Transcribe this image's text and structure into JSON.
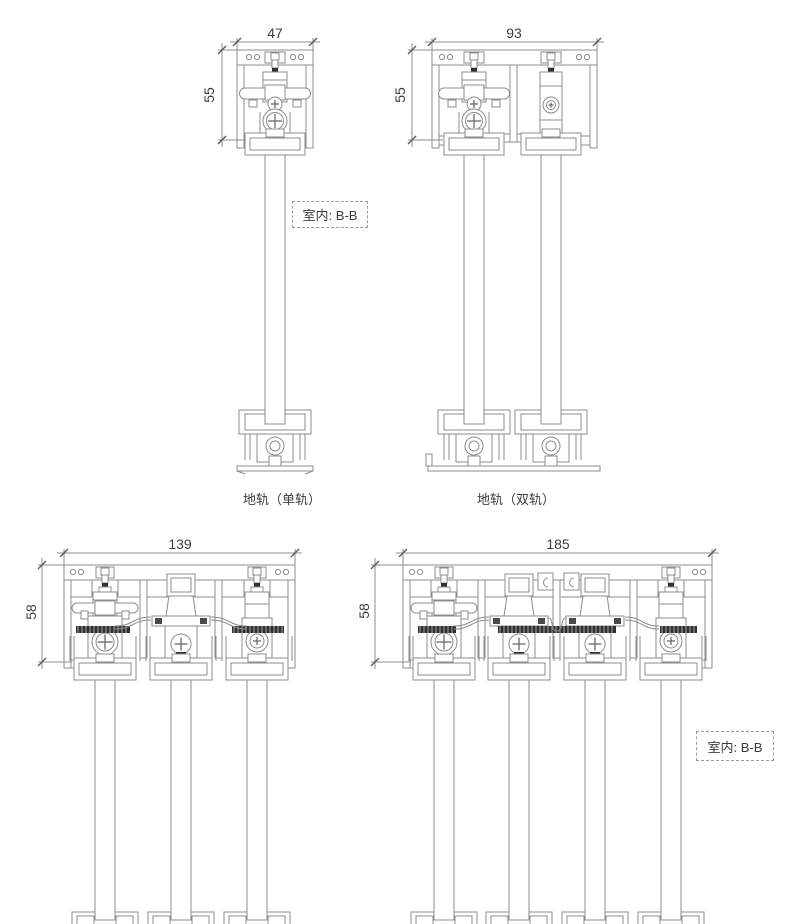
{
  "drawing": {
    "type": "technical-cross-section",
    "subject": "sliding-door-track-profiles",
    "background": "#ffffff",
    "line_color": "#8c8c8c",
    "dark_color": "#2f2f2f",
    "tick_color": "#5a5a5a",
    "text_color": "#3c3c3c"
  },
  "dimensions": {
    "top_single": {
      "width": "47",
      "height": "55"
    },
    "top_double": {
      "width": "93",
      "height": "55"
    },
    "bottom_triple": {
      "width": "139",
      "height": "58"
    },
    "bottom_quad": {
      "width": "185",
      "height": "58"
    }
  },
  "labels": {
    "indoor_section_top": "室内: B-B",
    "indoor_section_bottom": "室内: B-B",
    "caption_floor_single": "地轨（单轨）",
    "caption_floor_double": "地轨（双轨）"
  },
  "figures": [
    {
      "id": "top-track-single",
      "tracks": 1,
      "width_mm": 47,
      "height_mm": 55
    },
    {
      "id": "top-track-double",
      "tracks": 2,
      "width_mm": 93,
      "height_mm": 55
    },
    {
      "id": "top-track-triple",
      "tracks": 3,
      "width_mm": 139,
      "height_mm": 58
    },
    {
      "id": "top-track-quad",
      "tracks": 4,
      "width_mm": 185,
      "height_mm": 58
    }
  ]
}
